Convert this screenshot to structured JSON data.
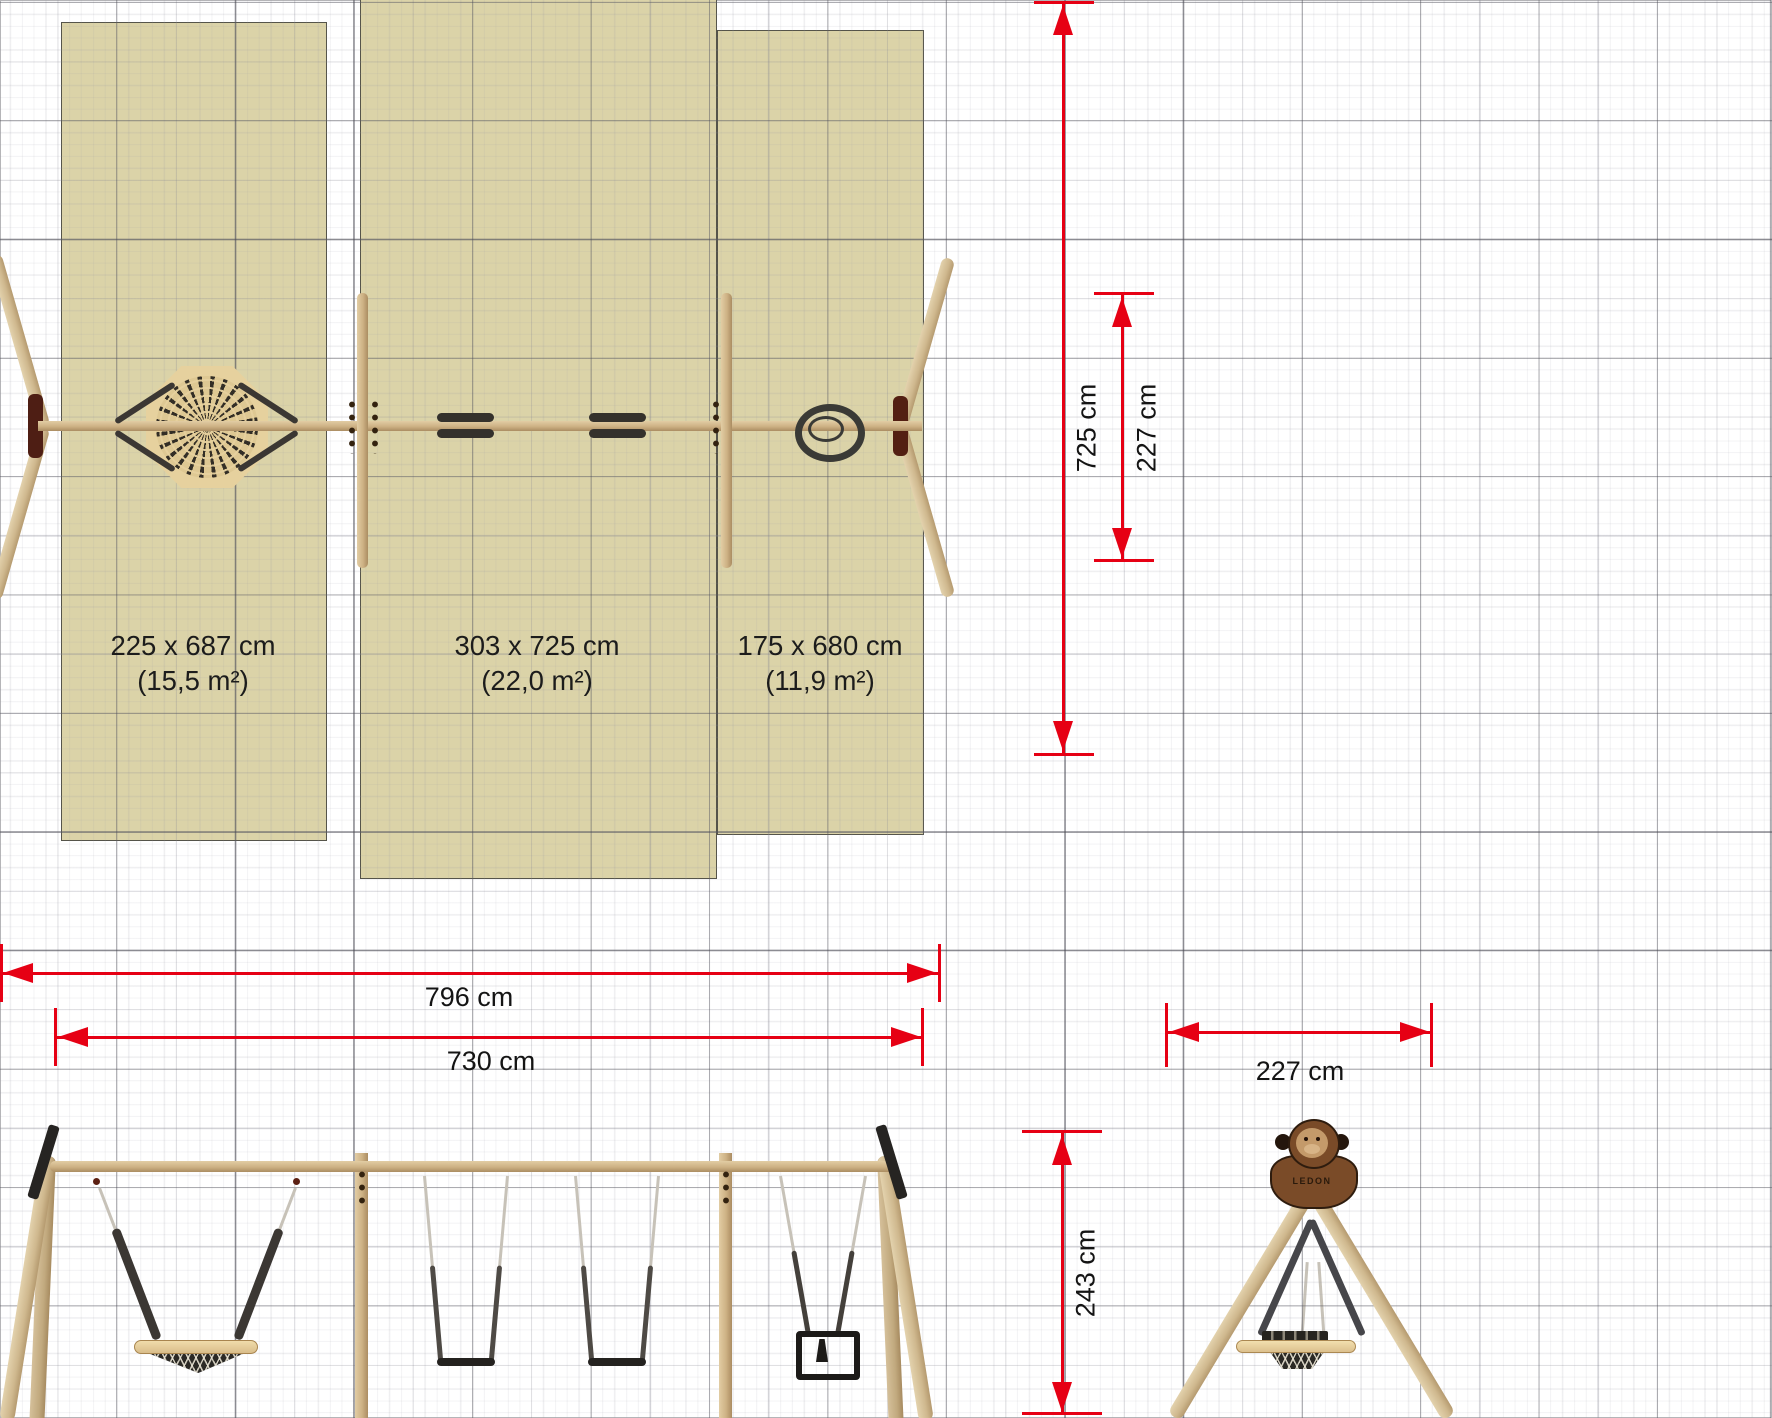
{
  "plan": {
    "zones": [
      {
        "size_label": "225 x 687 cm",
        "area_label": "(15,5 m²)"
      },
      {
        "size_label": "303 x 725 cm",
        "area_label": "(22,0 m²)"
      },
      {
        "size_label": "175 x 680 cm",
        "area_label": "(11,9 m²)"
      }
    ]
  },
  "dimensions": {
    "plan_depth": "725 cm",
    "plan_inner_depth": "227 cm",
    "total_width": "796 cm",
    "frame_width": "730 cm",
    "tripod_width": "227 cm",
    "tripod_height": "243 cm"
  },
  "branding": {
    "logo_text": "LEDON"
  },
  "colors": {
    "dimension_red": "#e60014",
    "safety_zone_fill": "#dbd3a8",
    "wood": "#cfb488",
    "hardware_dark": "#34312c",
    "logo_brown": "#7a4b28"
  }
}
